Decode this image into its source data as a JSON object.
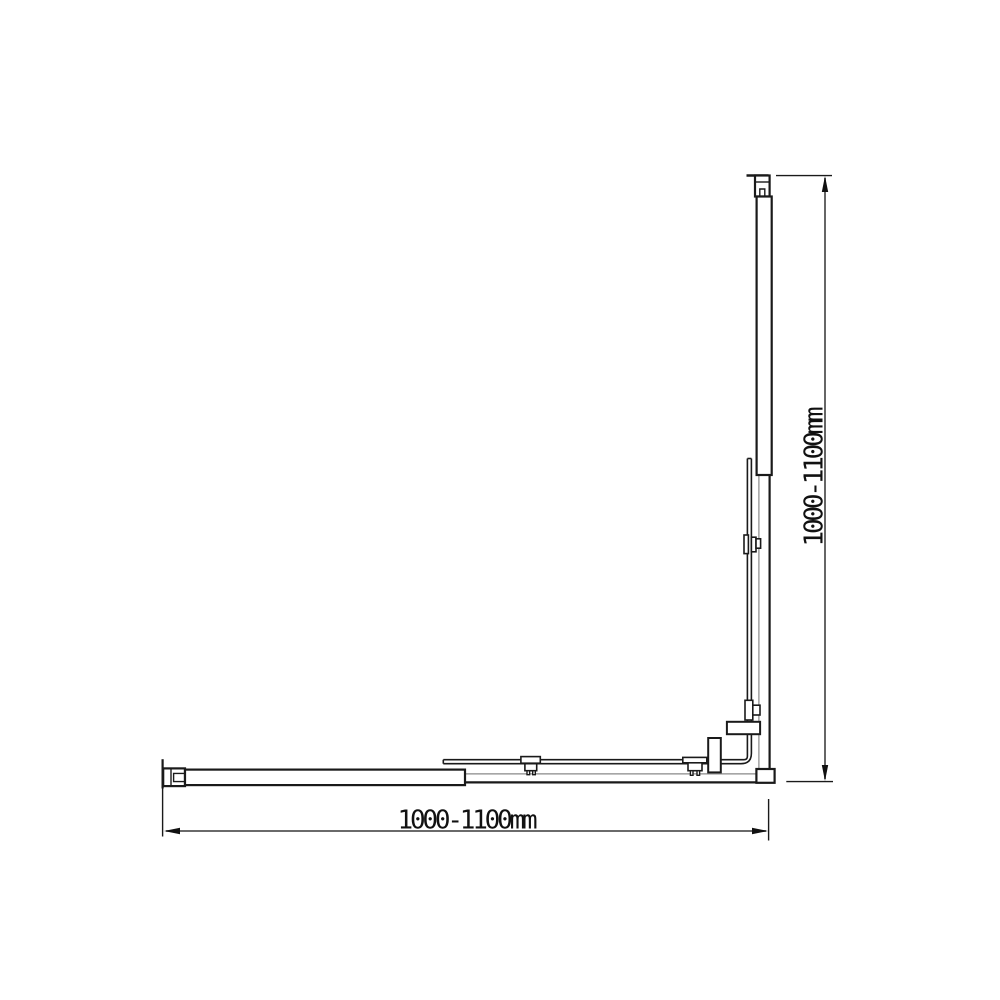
{
  "drawing": {
    "name": "corner-sliding-shower-screen-top-view",
    "components": [
      "top-wall-bracket",
      "right-fixed-panel",
      "right-rail",
      "sliding-door-assembly",
      "right-door-roller-bracket-upper",
      "right-door-roller-bracket-lower",
      "right-door-handle-bar",
      "left-wall-bracket",
      "bottom-fixed-panel",
      "bottom-rail",
      "bottom-door-roller-bracket-middle",
      "bottom-door-roller-bracket-corner",
      "bottom-door-handle-bar",
      "corner-block"
    ]
  },
  "dimensions": {
    "width": {
      "label": "1000-1100mm"
    },
    "height": {
      "label": "1000-1100mm"
    }
  },
  "colors": {
    "line": "#1a1a1a",
    "rail_light": "#888888",
    "dimension_line": "#555555",
    "arrow": "#111111",
    "background": "#ffffff"
  }
}
